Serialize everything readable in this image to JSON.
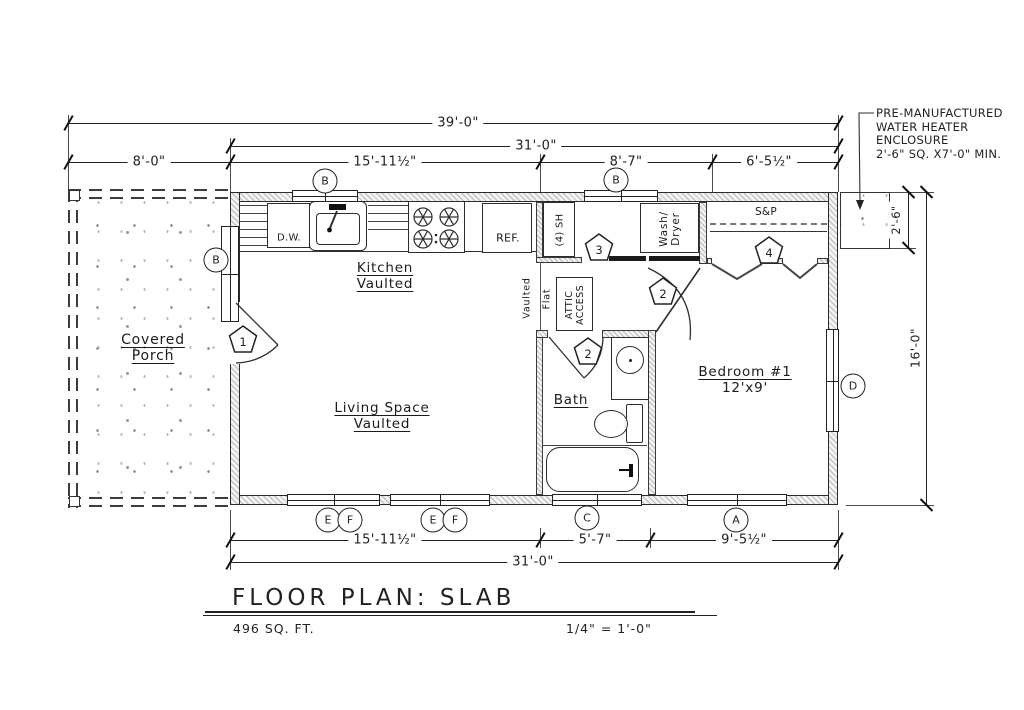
{
  "colors": {
    "ink": "#222222",
    "hatch": "#b9b9b9"
  },
  "title_block": {
    "title": "FLOOR PLAN: SLAB",
    "area": "496 SQ. FT.",
    "scale": "1/4\" = 1'-0\""
  },
  "note": {
    "line1": "PRE-MANUFACTURED",
    "line2": "WATER HEATER",
    "line3": "ENCLOSURE",
    "line4": "2'-6\" SQ. x7'-0\" MIN."
  },
  "rooms": {
    "porch_line1": "Covered",
    "porch_line2": "Porch",
    "kitchen_line1": "Kitchen",
    "kitchen_line2": "Vaulted",
    "living_line1": "Living Space",
    "living_line2": "Vaulted",
    "bath": "Bath",
    "bedroom_line1": "Bedroom #1",
    "bedroom_line2": "12'x9'"
  },
  "fixtures": {
    "dw": "D.W.",
    "ref": "REF.",
    "shelves": "(4) SH",
    "wash1": "Wash/",
    "wash2": "Dryer",
    "attic1": "ATTIC",
    "attic2": "ACCESS",
    "sp": "S&P",
    "vaulted": "Vaulted",
    "flat": "Flat"
  },
  "dims": {
    "overall": "39'-0\"",
    "house_top": "31'-0\"",
    "porch": "8'-0\"",
    "kitchen": "15'-11½\"",
    "hall": "8'-7\"",
    "closet": "6'-5½\"",
    "living_bottom": "15'-11½\"",
    "bath_bottom": "5'-7\"",
    "bedroom_bottom": "9'-5½\"",
    "house_bottom": "31'-0\"",
    "height": "16'-0\"",
    "water_heater_depth": "2'-6\""
  },
  "window_tags": {
    "kitchen": "B",
    "hall": "B",
    "porch_wall": "B",
    "bedroom_east": "D",
    "living1_e": "E",
    "living1_f": "F",
    "living2_e": "E",
    "living2_f": "F",
    "bath": "C",
    "bedroom_south": "A"
  },
  "door_tags": {
    "entry": "1",
    "bath": "2",
    "bedroom": "2",
    "laundry": "3",
    "closet": "4"
  }
}
